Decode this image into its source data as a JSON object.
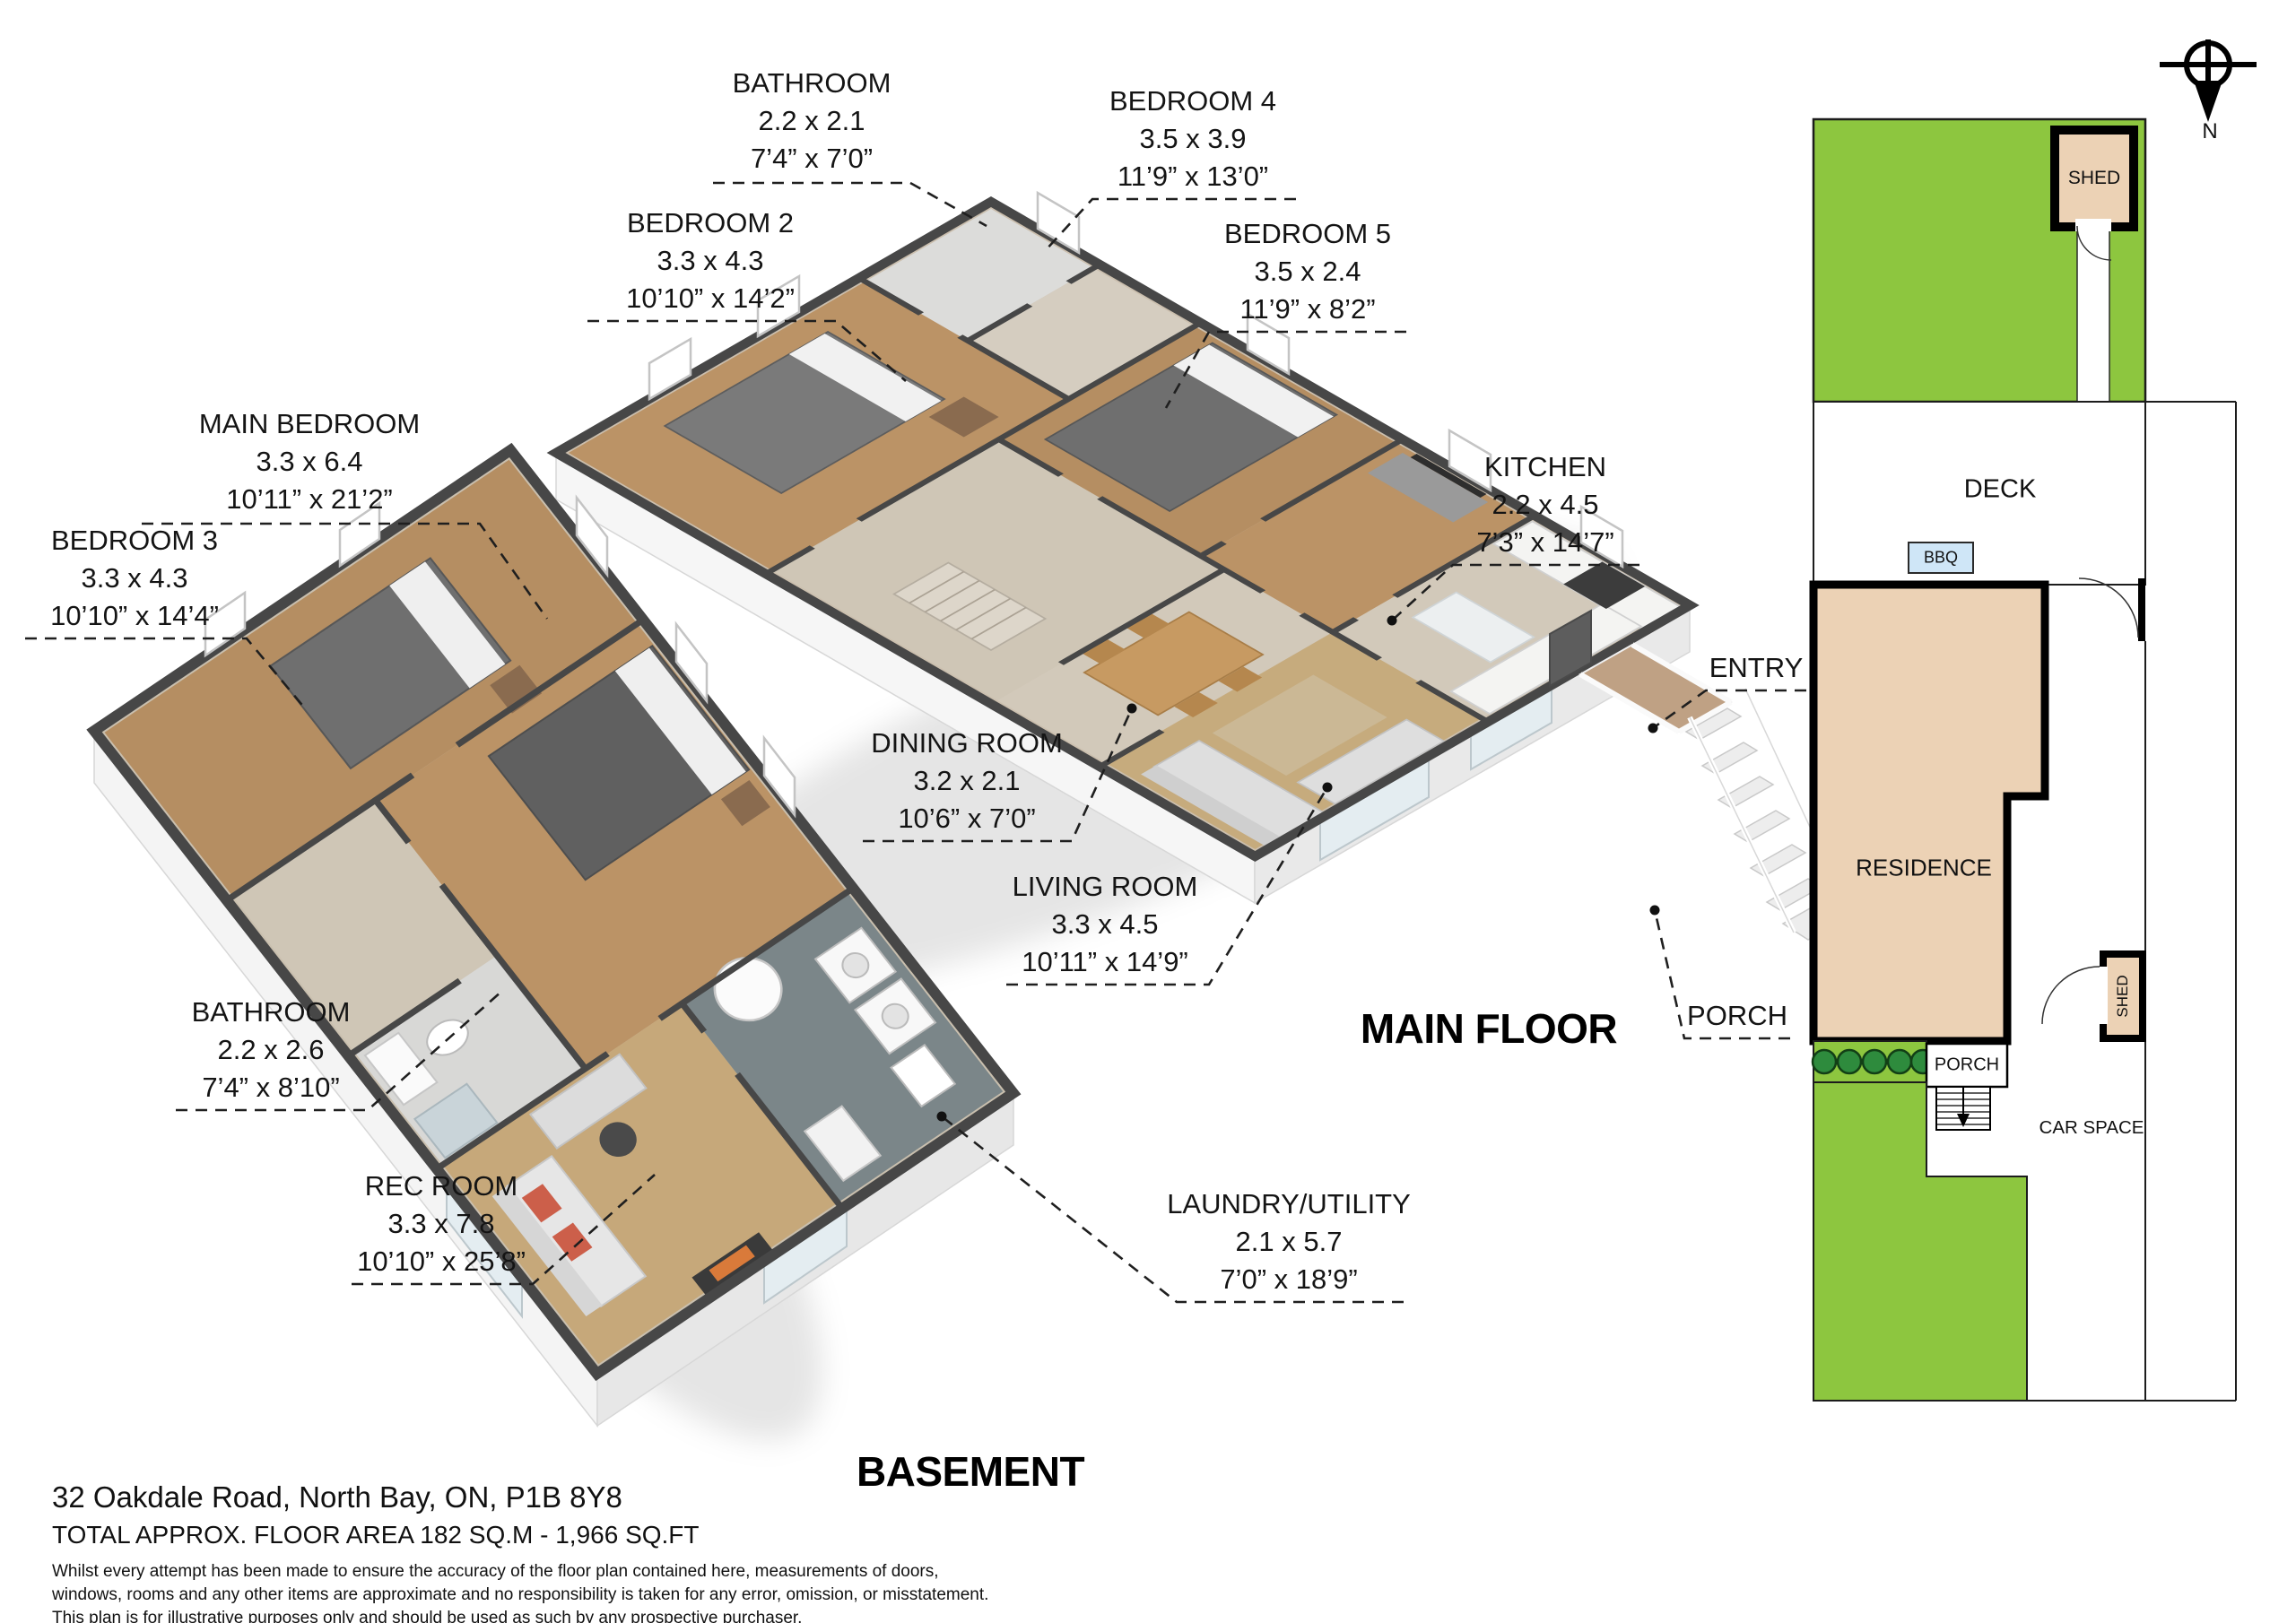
{
  "document": {
    "type": "floor-plan"
  },
  "rooms": {
    "bathroom_upper": {
      "name": "BATHROOM",
      "metric": "2.2 x 2.1",
      "imperial": "7’4” x 7’0”"
    },
    "bedroom2": {
      "name": "BEDROOM 2",
      "metric": "3.3 x 4.3",
      "imperial": "10’10” x 14’2”"
    },
    "bedroom4": {
      "name": "BEDROOM 4",
      "metric": "3.5 x 3.9",
      "imperial": "11’9” x 13’0”"
    },
    "bedroom5": {
      "name": "BEDROOM 5",
      "metric": "3.5 x 2.4",
      "imperial": "11’9” x 8’2”"
    },
    "main_bedroom": {
      "name": "MAIN BEDROOM",
      "metric": "3.3 x 6.4",
      "imperial": "10’11” x 21’2”"
    },
    "kitchen": {
      "name": "KITCHEN",
      "metric": "2.2 x 4.5",
      "imperial": "7’3” x 14’7”"
    },
    "bedroom3": {
      "name": "BEDROOM 3",
      "metric": "3.3 x 4.3",
      "imperial": "10’10” x 14’4”"
    },
    "dining": {
      "name": "DINING ROOM",
      "metric": "3.2 x 2.1",
      "imperial": "10’6” x 7’0”"
    },
    "living": {
      "name": "LIVING ROOM",
      "metric": "3.3 x 4.5",
      "imperial": "10’11” x 14’9”"
    },
    "entry": {
      "name": "ENTRY"
    },
    "porch_main": {
      "name": "PORCH"
    },
    "bathroom_basement": {
      "name": "BATHROOM",
      "metric": "2.2 x 2.6",
      "imperial": "7’4” x 8’10”"
    },
    "rec_room": {
      "name": "REC ROOM",
      "metric": "3.3 x 7.8",
      "imperial": "10’10” x 25’8”"
    },
    "laundry": {
      "name": "LAUNDRY/UTILITY",
      "metric": "2.1 x 5.7",
      "imperial": "7’0” x 18’9”"
    }
  },
  "floors": {
    "main_title": "MAIN FLOOR",
    "basement_title": "BASEMENT"
  },
  "site": {
    "shed_top": "SHED",
    "deck": "DECK",
    "bbq": "BBQ",
    "residence": "RESIDENCE",
    "porch": "PORCH",
    "shed_side": "SHED",
    "car_space": "CAR SPACE",
    "compass_north": "N",
    "colors": {
      "grass": "#8dc63f",
      "building_fill": "#ecd2b5",
      "bbq_fill": "#cfe6f7"
    }
  },
  "footer": {
    "address": "32 Oakdale Road, North Bay, ON, P1B 8Y8",
    "total_area": "TOTAL APPROX. FLOOR AREA  182 SQ.M - 1,966 SQ.FT",
    "disclaimer": [
      "Whilst every attempt has been made to ensure the accuracy of the floor plan contained here, measurements of doors,",
      "windows, rooms and any other items are approximate and no responsibility is taken for any error, omission, or misstatement.",
      "This plan is for illustrative purposes only and should be used as such by any prospective purchaser."
    ]
  }
}
